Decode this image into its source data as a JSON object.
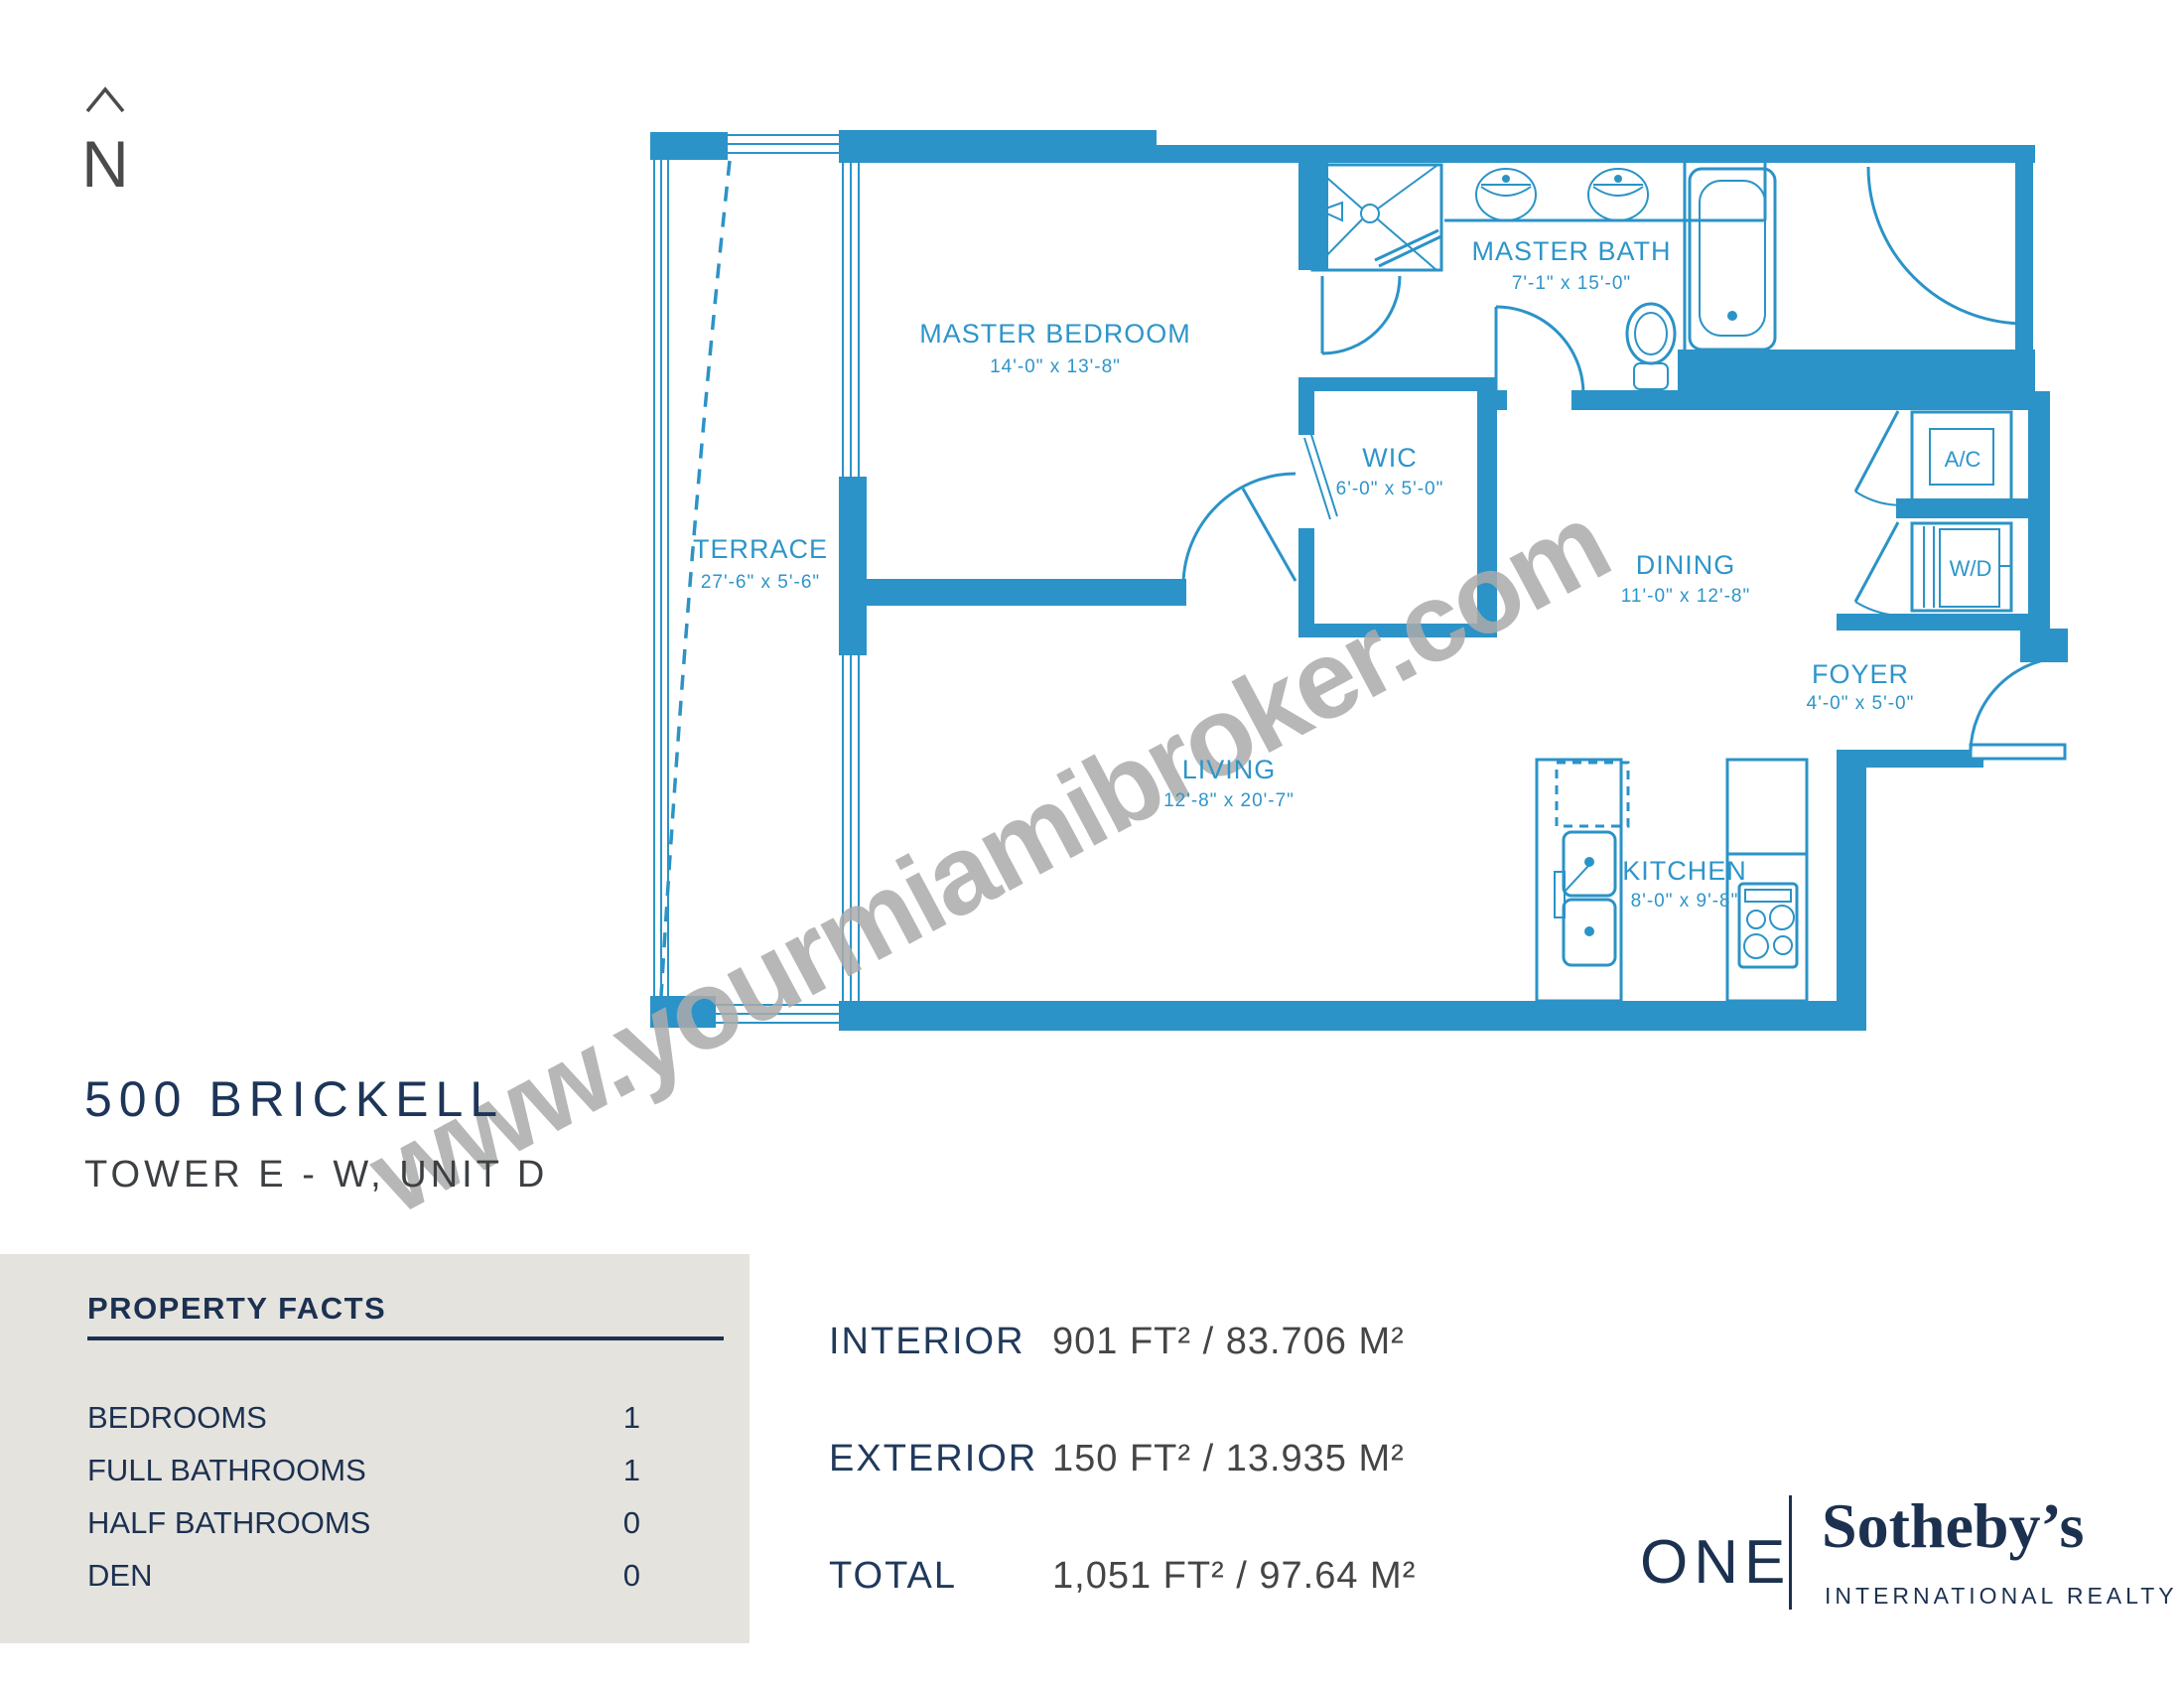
{
  "north": {
    "label": "N"
  },
  "plan": {
    "watermark": "www.yourmiamibroker.com",
    "rooms": {
      "terrace": {
        "name": "TERRACE",
        "dims": "27'-6\" x 5'-6\""
      },
      "master_bedroom": {
        "name": "MASTER BEDROOM",
        "dims": "14'-0\" x 13'-8\""
      },
      "master_bath": {
        "name": "MASTER BATH",
        "dims": "7'-1\" x 15'-0\""
      },
      "wic": {
        "name": "WIC",
        "dims": "6'-0\" x 5'-0\""
      },
      "dining": {
        "name": "DINING",
        "dims": "11'-0\" x 12'-8\""
      },
      "foyer": {
        "name": "FOYER",
        "dims": "4'-0\" x 5'-0\""
      },
      "living": {
        "name": "LIVING",
        "dims": "12'-8\" x 20'-7\""
      },
      "kitchen": {
        "name": "KITCHEN",
        "dims": "8'-0\" x 9'-8\""
      },
      "ac_closet": {
        "name": "A/C"
      },
      "wd_closet": {
        "name": "W/D"
      }
    }
  },
  "title": {
    "building": "500 BRICKELL",
    "unit": "TOWER E - W, UNIT D"
  },
  "property_facts": {
    "title": "PROPERTY FACTS",
    "rows": [
      {
        "label": "BEDROOMS",
        "value": "1"
      },
      {
        "label": "FULL BATHROOMS",
        "value": "1"
      },
      {
        "label": "HALF BATHROOMS",
        "value": "0"
      },
      {
        "label": "DEN",
        "value": "0"
      }
    ]
  },
  "areas": {
    "rows": [
      {
        "label": "INTERIOR",
        "value": "901 FT²  / 83.706 M²"
      },
      {
        "label": "EXTERIOR",
        "value": "150 FT²  / 13.935 M²"
      },
      {
        "label": "TOTAL",
        "value": "1,051 FT²  /  97.64 M²"
      }
    ]
  },
  "logo": {
    "one": "ONE",
    "brand": "Sotheby’s",
    "tagline": "INTERNATIONAL REALTY"
  },
  "colors": {
    "plan_blue": "#2B93C7",
    "navy": "#1C3150",
    "panel_bg": "#E5E3DE",
    "watermark_gray": "#ABABAB"
  }
}
